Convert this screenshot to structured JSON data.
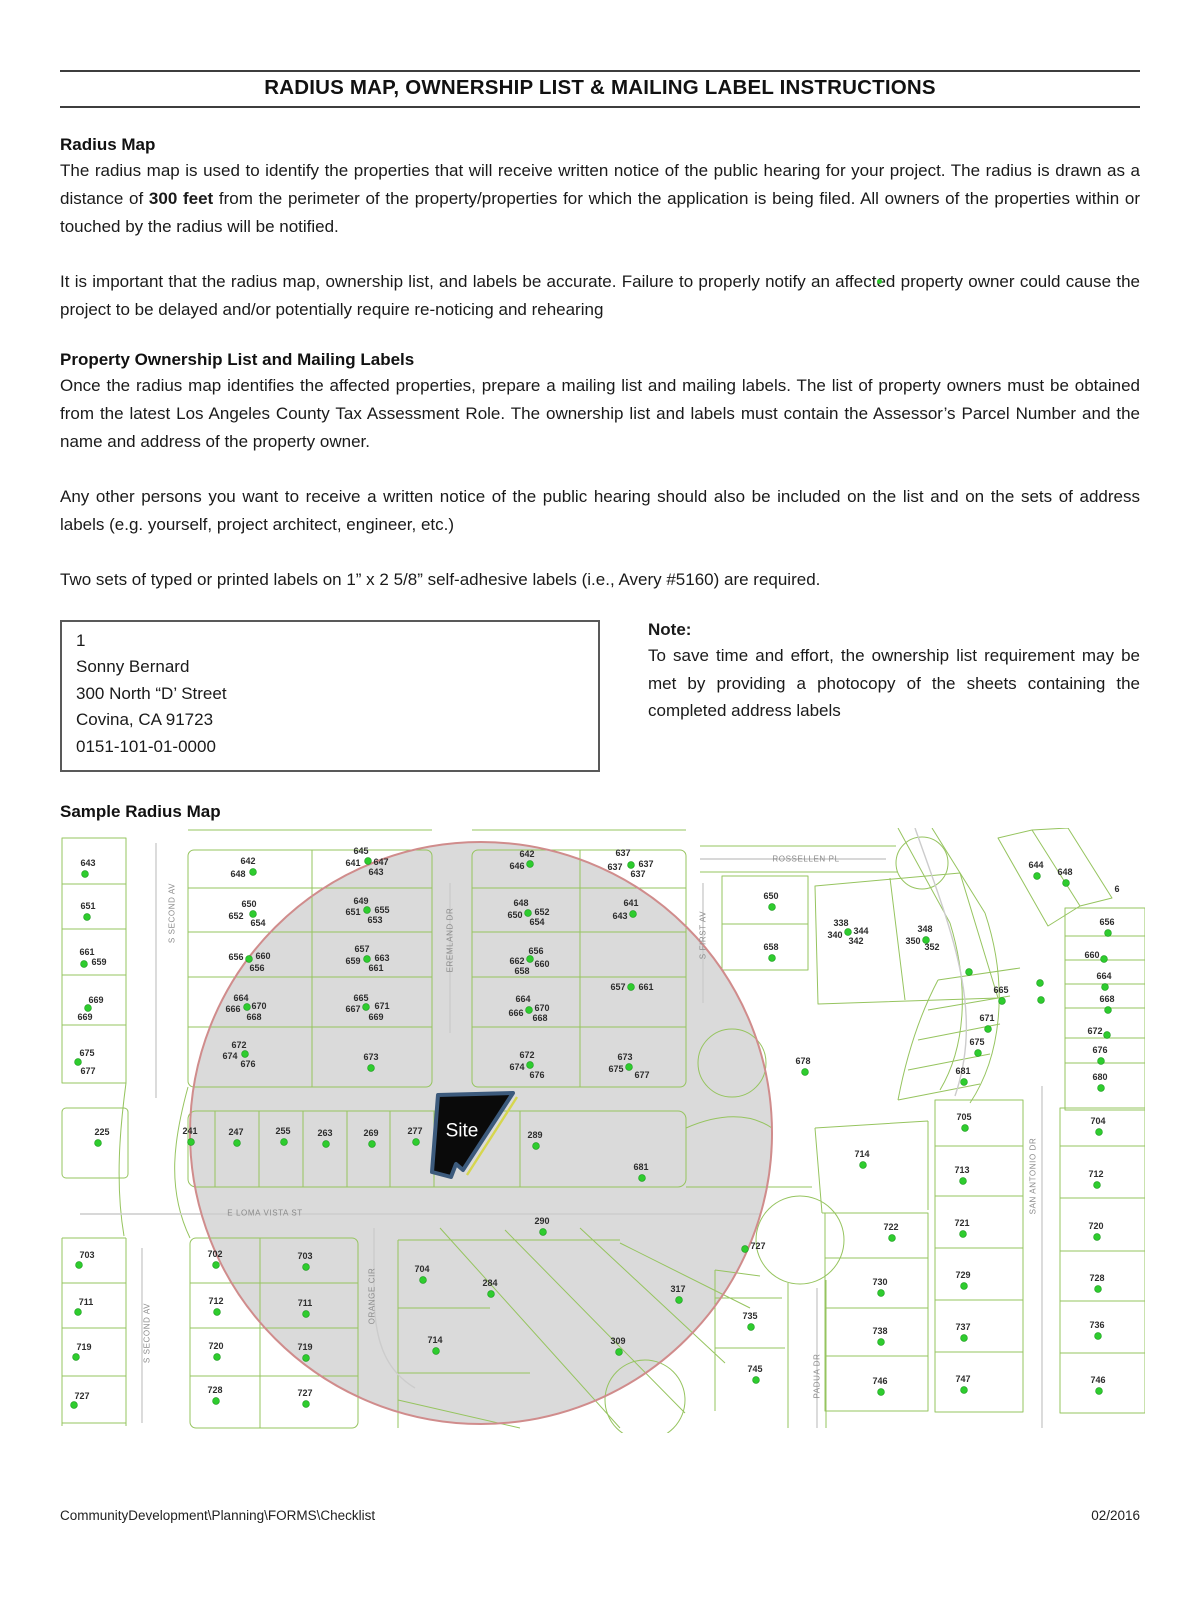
{
  "page": {
    "title": "RADIUS MAP, OWNERSHIP LIST & MAILING LABEL INSTRUCTIONS",
    "footer_left": "CommunityDevelopment\\Planning\\FORMS\\Checklist",
    "footer_right": "02/2016"
  },
  "sections": {
    "radius_map": {
      "heading": "Radius Map",
      "para1_pre": "The radius map is used to identify the properties that will receive written notice of the public hearing for your project. The radius is drawn as a distance of ",
      "para1_bold": "300 feet",
      "para1_post": " from the perimeter of the property/properties for which the application is being filed. All owners of the properties within or touched by the radius will be notified.",
      "para2": "It is important that the radius map, ownership list, and labels be accurate. Failure to properly notify an affected property owner could cause the project to be delayed and/or potentially require re-noticing and rehearing"
    },
    "ownership": {
      "heading": "Property Ownership List and Mailing Labels",
      "para1": "Once the radius map identifies the affected properties, prepare a mailing list and mailing labels. The list of property owners must be obtained from the latest Los Angeles County Tax Assessment Role. The ownership list and labels must contain the Assessor’s Parcel Number and the name and address of the property owner.",
      "para2": "Any other persons you want to receive a written notice of the public hearing should also be included on the list and on the sets of address labels (e.g. yourself, project architect, engineer, etc.)",
      "para3": "Two sets of typed or printed labels on 1” x 2 5/8” self-adhesive labels (i.e., Avery #5160) are required."
    },
    "label_box": {
      "lines": [
        "1",
        "Sonny Bernard",
        "300 North “D’ Street",
        "Covina, CA 91723",
        "0151-101-01-0000"
      ]
    },
    "note": {
      "heading": "Note:",
      "body": "To save time and effort, the ownership list requirement may be met by providing a photocopy of the sheets containing the completed address labels"
    },
    "sample_heading": "Sample Radius Map"
  },
  "map": {
    "site_label": "Site",
    "colors": {
      "parcel_line": "#96c45f",
      "dot": "#2ecc2e",
      "dot_edge": "#17991a",
      "radius_ring": "#d08c8c",
      "radius_fill": "#dadada",
      "label": "#2d2d2d",
      "street": "#8b8b8b",
      "road": "#cccccc",
      "site_fill": "#0a0a0a",
      "site_border": "#3c5a7c",
      "site_accent": "#d6d64e"
    },
    "street_labels": [
      [
        "S SECOND AV",
        112,
        85,
        -90
      ],
      [
        "EREMLAND DR",
        390,
        112,
        -90
      ],
      [
        "S FIRST AV",
        643,
        107,
        -90
      ],
      [
        "ROSSELLEN PL",
        746,
        31,
        0
      ],
      [
        "E LOMA VISTA ST",
        205,
        385,
        0
      ],
      [
        "ORANGE CIR",
        312,
        468,
        -90
      ],
      [
        "S SECOND AV",
        87,
        505,
        -90
      ],
      [
        "SAN ANTONIO DR",
        973,
        348,
        -90
      ],
      [
        "PADUA DR",
        757,
        548,
        -90
      ]
    ],
    "parcel_labels": [
      [
        "643",
        28,
        35
      ],
      [
        "651",
        28,
        78
      ],
      [
        "661",
        27,
        124
      ],
      [
        "659",
        39,
        134
      ],
      [
        "669",
        36,
        172
      ],
      [
        "669",
        25,
        189
      ],
      [
        "675",
        27,
        225
      ],
      [
        "677",
        28,
        243
      ],
      [
        "225",
        42,
        304
      ],
      [
        "703",
        27,
        427
      ],
      [
        "711",
        26,
        474
      ],
      [
        "719",
        24,
        519
      ],
      [
        "727",
        22,
        568
      ],
      [
        "642",
        188,
        33
      ],
      [
        "648",
        178,
        46
      ],
      [
        "650",
        189,
        76
      ],
      [
        "652",
        176,
        88
      ],
      [
        "654",
        198,
        95
      ],
      [
        "656",
        176,
        129
      ],
      [
        "660",
        203,
        128
      ],
      [
        "656",
        197,
        140
      ],
      [
        "664",
        181,
        170
      ],
      [
        "666",
        173,
        181
      ],
      [
        "670",
        199,
        178
      ],
      [
        "668",
        194,
        189
      ],
      [
        "672",
        179,
        217
      ],
      [
        "674",
        170,
        228
      ],
      [
        "676",
        188,
        236
      ],
      [
        "645",
        301,
        23
      ],
      [
        "641",
        293,
        35
      ],
      [
        "647",
        321,
        34
      ],
      [
        "643",
        316,
        44
      ],
      [
        "649",
        301,
        73
      ],
      [
        "651",
        293,
        84
      ],
      [
        "655",
        322,
        82
      ],
      [
        "653",
        315,
        92
      ],
      [
        "657",
        302,
        121
      ],
      [
        "659",
        293,
        133
      ],
      [
        "663",
        322,
        130
      ],
      [
        "661",
        316,
        140
      ],
      [
        "665",
        301,
        170
      ],
      [
        "667",
        293,
        181
      ],
      [
        "671",
        322,
        178
      ],
      [
        "669",
        316,
        189
      ],
      [
        "673",
        311,
        229
      ],
      [
        "642",
        467,
        26
      ],
      [
        "646",
        457,
        38
      ],
      [
        "648",
        461,
        75
      ],
      [
        "650",
        455,
        87
      ],
      [
        "652",
        482,
        84
      ],
      [
        "654",
        477,
        94
      ],
      [
        "656",
        476,
        123
      ],
      [
        "662",
        457,
        133
      ],
      [
        "660",
        482,
        136
      ],
      [
        "658",
        462,
        143
      ],
      [
        "664",
        463,
        171
      ],
      [
        "666",
        456,
        185
      ],
      [
        "670",
        482,
        180
      ],
      [
        "668",
        480,
        190
      ],
      [
        "672",
        467,
        227
      ],
      [
        "674",
        457,
        239
      ],
      [
        "676",
        477,
        247
      ],
      [
        "637",
        563,
        25
      ],
      [
        "637",
        555,
        39
      ],
      [
        "637",
        586,
        36
      ],
      [
        "637",
        578,
        46
      ],
      [
        "641",
        571,
        75
      ],
      [
        "643",
        560,
        88
      ],
      [
        "657",
        558,
        159
      ],
      [
        "661",
        586,
        159
      ],
      [
        "673",
        565,
        229
      ],
      [
        "675",
        556,
        241
      ],
      [
        "677",
        582,
        247
      ],
      [
        "650",
        711,
        68
      ],
      [
        "658",
        711,
        119
      ],
      [
        "678",
        743,
        233
      ],
      [
        "338",
        781,
        95
      ],
      [
        "340",
        775,
        107
      ],
      [
        "344",
        801,
        103
      ],
      [
        "342",
        796,
        113
      ],
      [
        "348",
        865,
        101
      ],
      [
        "350",
        853,
        113
      ],
      [
        "352",
        872,
        119
      ],
      [
        "644",
        976,
        37
      ],
      [
        "648",
        1005,
        44
      ],
      [
        "6",
        1057,
        61
      ],
      [
        "656",
        1047,
        94
      ],
      [
        "660",
        1032,
        127
      ],
      [
        "664",
        1044,
        148
      ],
      [
        "668",
        1047,
        171
      ],
      [
        "672",
        1035,
        203
      ],
      [
        "676",
        1040,
        222
      ],
      [
        "680",
        1040,
        249
      ],
      [
        "665",
        941,
        162
      ],
      [
        "671",
        927,
        190
      ],
      [
        "675",
        917,
        214
      ],
      [
        "681",
        903,
        243
      ],
      [
        "705",
        904,
        289
      ],
      [
        "704",
        1038,
        293
      ],
      [
        "714",
        802,
        326
      ],
      [
        "713",
        902,
        342
      ],
      [
        "712",
        1036,
        346
      ],
      [
        "722",
        831,
        399
      ],
      [
        "721",
        902,
        395
      ],
      [
        "720",
        1036,
        398
      ],
      [
        "727",
        698,
        418
      ],
      [
        "730",
        820,
        454
      ],
      [
        "729",
        903,
        447
      ],
      [
        "728",
        1037,
        450
      ],
      [
        "735",
        690,
        488
      ],
      [
        "738",
        820,
        503
      ],
      [
        "737",
        903,
        499
      ],
      [
        "736",
        1037,
        497
      ],
      [
        "745",
        695,
        541
      ],
      [
        "746",
        820,
        553
      ],
      [
        "747",
        903,
        551
      ],
      [
        "746",
        1038,
        552
      ],
      [
        "317",
        618,
        461
      ],
      [
        "309",
        558,
        513
      ],
      [
        "289",
        475,
        307
      ],
      [
        "681",
        581,
        339
      ],
      [
        "290",
        482,
        393
      ],
      [
        "284",
        430,
        455
      ],
      [
        "241",
        130,
        303
      ],
      [
        "247",
        176,
        304
      ],
      [
        "255",
        223,
        303
      ],
      [
        "263",
        265,
        305
      ],
      [
        "269",
        311,
        305
      ],
      [
        "277",
        355,
        303
      ],
      [
        "702",
        155,
        426
      ],
      [
        "703",
        245,
        428
      ],
      [
        "712",
        156,
        473
      ],
      [
        "711",
        245,
        475
      ],
      [
        "720",
        156,
        518
      ],
      [
        "719",
        245,
        519
      ],
      [
        "728",
        155,
        562
      ],
      [
        "727",
        245,
        565
      ],
      [
        "704",
        362,
        441
      ],
      [
        "714",
        375,
        512
      ]
    ],
    "dots": [
      [
        25,
        46
      ],
      [
        27,
        89
      ],
      [
        24,
        136
      ],
      [
        28,
        180
      ],
      [
        18,
        234
      ],
      [
        38,
        315
      ],
      [
        19,
        437
      ],
      [
        18,
        484
      ],
      [
        16,
        529
      ],
      [
        14,
        577
      ],
      [
        193,
        44
      ],
      [
        193,
        86
      ],
      [
        189,
        131
      ],
      [
        187,
        179
      ],
      [
        185,
        226
      ],
      [
        308,
        33
      ],
      [
        307,
        82
      ],
      [
        307,
        131
      ],
      [
        306,
        179
      ],
      [
        311,
        240
      ],
      [
        470,
        36
      ],
      [
        468,
        85
      ],
      [
        470,
        131
      ],
      [
        469,
        182
      ],
      [
        470,
        237
      ],
      [
        571,
        37
      ],
      [
        573,
        86
      ],
      [
        571,
        159
      ],
      [
        569,
        239
      ],
      [
        712,
        79
      ],
      [
        712,
        130
      ],
      [
        745,
        244
      ],
      [
        788,
        104
      ],
      [
        866,
        112
      ],
      [
        977,
        48
      ],
      [
        1006,
        55
      ],
      [
        1048,
        105
      ],
      [
        1044,
        131
      ],
      [
        1045,
        159
      ],
      [
        1048,
        182
      ],
      [
        1047,
        207
      ],
      [
        1041,
        233
      ],
      [
        1041,
        260
      ],
      [
        1039,
        304
      ],
      [
        1037,
        357
      ],
      [
        1037,
        409
      ],
      [
        1038,
        461
      ],
      [
        1038,
        508
      ],
      [
        1039,
        563
      ],
      [
        942,
        173
      ],
      [
        928,
        201
      ],
      [
        918,
        225
      ],
      [
        904,
        254
      ],
      [
        909,
        144
      ],
      [
        980,
        155
      ],
      [
        981,
        172
      ],
      [
        905,
        300
      ],
      [
        903,
        353
      ],
      [
        903,
        406
      ],
      [
        904,
        458
      ],
      [
        904,
        510
      ],
      [
        904,
        562
      ],
      [
        803,
        337
      ],
      [
        832,
        410
      ],
      [
        821,
        465
      ],
      [
        821,
        514
      ],
      [
        821,
        564
      ],
      [
        685,
        421
      ],
      [
        691,
        499
      ],
      [
        696,
        552
      ],
      [
        476,
        318
      ],
      [
        582,
        350
      ],
      [
        483,
        404
      ],
      [
        431,
        466
      ],
      [
        619,
        472
      ],
      [
        559,
        524
      ],
      [
        131,
        314
      ],
      [
        177,
        315
      ],
      [
        224,
        314
      ],
      [
        266,
        316
      ],
      [
        312,
        316
      ],
      [
        356,
        314
      ],
      [
        156,
        437
      ],
      [
        246,
        439
      ],
      [
        157,
        484
      ],
      [
        246,
        486
      ],
      [
        157,
        529
      ],
      [
        246,
        530
      ],
      [
        156,
        573
      ],
      [
        246,
        576
      ],
      [
        363,
        452
      ],
      [
        376,
        523
      ]
    ]
  }
}
